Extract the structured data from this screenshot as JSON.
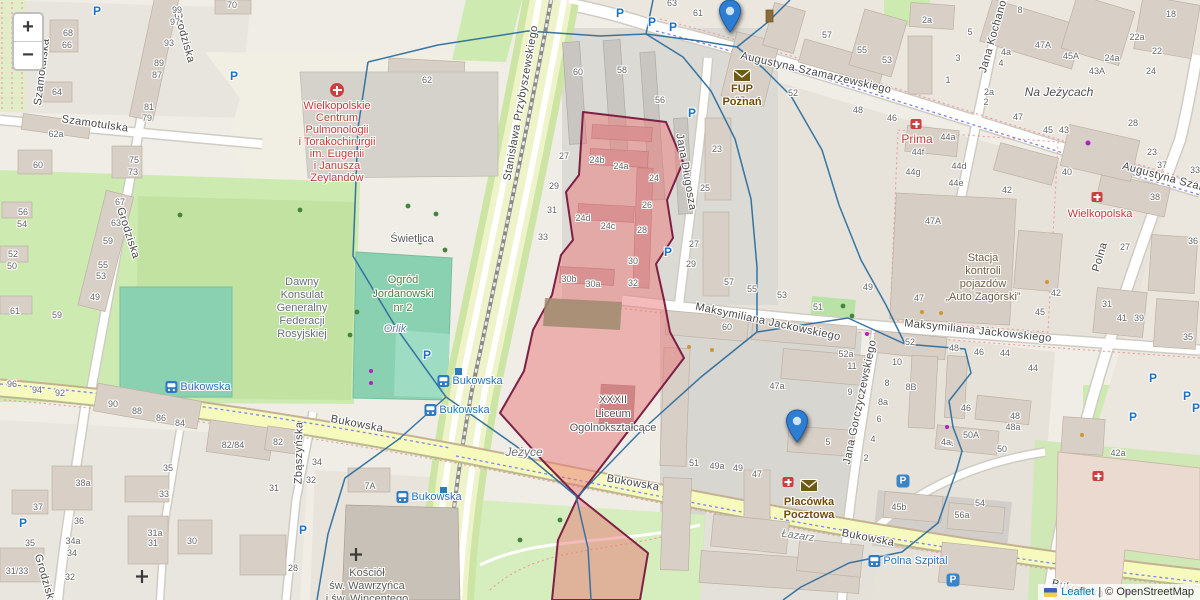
{
  "controls": {
    "zoom_in": "+",
    "zoom_out": "−"
  },
  "attribution": {
    "leaflet": "Leaflet",
    "separator": "|",
    "copyright": "© OpenStreetMap"
  },
  "colors": {
    "marker_blue": "#2d7ed3",
    "selection_fill": "#e87878",
    "selection_border": "#7d2046",
    "cell_line": "#2e6f9e",
    "transit_blue": "#2373bd",
    "poi_red": "#c33b36",
    "post_brown": "#734a08"
  },
  "markers": [
    {
      "id": "fup-poznan",
      "lines": [
        "FUP Poznań"
      ],
      "x": 742,
      "tip_y": 67,
      "label_dy": 16
    },
    {
      "id": "placowka-pocztowa",
      "lines": [
        "Placówka",
        "Pocztowa"
      ],
      "x": 809,
      "tip_y": 477,
      "label_dy": 19
    }
  ],
  "street_labels": [
    {
      "t": "Szamotulska",
      "x": 42,
      "y": 72,
      "r": -83
    },
    {
      "t": "Szamotulska",
      "x": 95,
      "y": 124,
      "r": 8
    },
    {
      "t": "Grodziska",
      "x": 184,
      "y": 37,
      "r": 74
    },
    {
      "t": "Grodziska",
      "x": 128,
      "y": 233,
      "r": 72
    },
    {
      "t": "Grodziska",
      "x": 45,
      "y": 580,
      "r": 74
    },
    {
      "t": "Stanisława Przybyszewskiego",
      "x": 521,
      "y": 103,
      "r": -80
    },
    {
      "t": "Augustyna Szamarzewskiego",
      "x": 816,
      "y": 73,
      "r": 13
    },
    {
      "t": "Augustyna Szamarzewskiego",
      "x": 1197,
      "y": 186,
      "r": 15
    },
    {
      "t": "Maksymiliana Jackowskiego",
      "x": 768,
      "y": 322,
      "r": 12
    },
    {
      "t": "Maksymiliana Jackowskiego",
      "x": 978,
      "y": 331,
      "r": 6
    },
    {
      "t": "Jana Długosza",
      "x": 686,
      "y": 172,
      "r": 80
    },
    {
      "t": "Jana Gorczyczewskiego",
      "x": 860,
      "y": 402,
      "r": -78
    },
    {
      "t": "Polna",
      "x": 1100,
      "y": 257,
      "r": -74
    },
    {
      "t": "Zbąszyńska",
      "x": 299,
      "y": 453,
      "r": -89
    },
    {
      "t": "Bukowska",
      "x": 357,
      "y": 424,
      "r": 11
    },
    {
      "t": "Bukowska",
      "x": 633,
      "y": 483,
      "r": 10
    },
    {
      "t": "Bukowska",
      "x": 868,
      "y": 538,
      "r": 11
    },
    {
      "t": "Bukowska",
      "x": 1078,
      "y": 589,
      "r": 12
    },
    {
      "t": "Jana Kochanowskiego",
      "x": 999,
      "y": 16,
      "r": -74
    }
  ],
  "place_labels": [
    {
      "lines": [
        "Wielkopolskie",
        "Centrum",
        "Pulmonologii",
        "i Torakochirurgii",
        "im. Eugenii",
        "i Janusza",
        "Zeylandów"
      ],
      "x": 337,
      "y": 100,
      "lh": 12,
      "color": "#c33b36"
    },
    {
      "lines": [
        "Prima"
      ],
      "x": 917,
      "y": 133,
      "lh": 12,
      "color": "#c33b36",
      "size": 12
    },
    {
      "lines": [
        "Wielkopolska"
      ],
      "x": 1100,
      "y": 208,
      "lh": 12,
      "color": "#c33b36"
    },
    {
      "lines": [
        "Stacja",
        "kontroli",
        "pojazdów",
        "„Auto Zagórski”"
      ],
      "x": 983,
      "y": 252,
      "lh": 13,
      "color": "#6f5b40"
    },
    {
      "lines": [
        "Dawny",
        "Konsulat",
        "Generalny",
        "Federacji",
        "Rosyjskiej"
      ],
      "x": 302,
      "y": 276,
      "lh": 13,
      "color": "#657075"
    },
    {
      "lines": [
        "Ogród",
        "Jordanowski",
        "nr 2"
      ],
      "x": 403,
      "y": 273,
      "lh": 14,
      "color": "#4c7e3c"
    },
    {
      "lines": [
        "Orlik"
      ],
      "x": 395,
      "y": 323,
      "lh": 12,
      "color": "#64869c",
      "italic": true
    },
    {
      "lines": [
        "Świetlica"
      ],
      "x": 412,
      "y": 233,
      "lh": 12,
      "color": "#5a5a5a"
    },
    {
      "lines": [
        "Jeżyce"
      ],
      "x": 524,
      "y": 446,
      "lh": 13,
      "color": "#707070",
      "italic": true,
      "size": 12
    },
    {
      "lines": [
        "Na Jeżycach"
      ],
      "x": 1059,
      "y": 86,
      "lh": 13,
      "color": "#4f4f4f",
      "italic": true,
      "size": 12
    },
    {
      "lines": [
        "Kościół",
        "św. Wawrzyńca",
        "i św. Wincentego"
      ],
      "x": 367,
      "y": 567,
      "lh": 13,
      "color": "#5c5c56"
    },
    {
      "lines": [
        "XXXII",
        "Liceum",
        "Ogólnokształcące"
      ],
      "x": 613,
      "y": 393,
      "lh": 14,
      "color": "#555555"
    },
    {
      "lines": [
        "Łazarz"
      ],
      "x": 798,
      "y": 530,
      "lh": 12,
      "color": "#777777",
      "italic": true,
      "rot": 8
    }
  ],
  "transit_labels": [
    {
      "t": "Bukowska",
      "x": 198,
      "y": 387
    },
    {
      "t": "Bukowska",
      "x": 470,
      "y": 381
    },
    {
      "t": "Bukowska",
      "x": 457,
      "y": 410
    },
    {
      "t": "Bukowska",
      "x": 429,
      "y": 497
    },
    {
      "t": "Polna Szpital",
      "x": 908,
      "y": 561
    }
  ],
  "parking_label": "P",
  "parking_icons": [
    {
      "x": 97,
      "y": 11
    },
    {
      "x": 234,
      "y": 76
    },
    {
      "x": 620,
      "y": 13
    },
    {
      "x": 652,
      "y": 22
    },
    {
      "x": 673,
      "y": 27
    },
    {
      "x": 692,
      "y": 113
    },
    {
      "x": 668,
      "y": 252
    },
    {
      "x": 427,
      "y": 355
    },
    {
      "x": 303,
      "y": 530
    },
    {
      "x": 23,
      "y": 523
    },
    {
      "x": 1153,
      "y": 378
    },
    {
      "x": 1187,
      "y": 396
    },
    {
      "x": 1196,
      "y": 408
    },
    {
      "x": 1133,
      "y": 417
    },
    {
      "x": 903,
      "y": 481,
      "boxed": true
    },
    {
      "x": 953,
      "y": 580,
      "boxed": true
    }
  ],
  "poi_icons": [
    {
      "type": "hospital",
      "x": 337,
      "y": 90
    },
    {
      "type": "aid",
      "x": 916,
      "y": 124
    },
    {
      "type": "aid",
      "x": 1097,
      "y": 197
    },
    {
      "type": "aid",
      "x": 788,
      "y": 482
    },
    {
      "type": "aid",
      "x": 1098,
      "y": 476
    }
  ],
  "building_numbers": [
    [
      "70",
      232,
      5
    ],
    [
      "99",
      177,
      10
    ],
    [
      "97",
      175,
      22
    ],
    [
      "93",
      169,
      43
    ],
    [
      "89",
      159,
      63
    ],
    [
      "87",
      157,
      75
    ],
    [
      "68",
      68,
      33
    ],
    [
      "66",
      67,
      45
    ],
    [
      "64",
      57,
      92
    ],
    [
      "81",
      149,
      107
    ],
    [
      "79",
      147,
      118
    ],
    [
      "62a",
      56,
      134
    ],
    [
      "60",
      38,
      165
    ],
    [
      "75",
      134,
      160
    ],
    [
      "73",
      133,
      172
    ],
    [
      "56",
      23,
      212
    ],
    [
      "54",
      22,
      224
    ],
    [
      "52",
      13,
      254
    ],
    [
      "50",
      12,
      266
    ],
    [
      "67",
      120,
      202
    ],
    [
      "63",
      116,
      223
    ],
    [
      "59",
      108,
      241
    ],
    [
      "55",
      103,
      265
    ],
    [
      "53",
      101,
      276
    ],
    [
      "49",
      95,
      297
    ],
    [
      "61",
      15,
      311
    ],
    [
      "59",
      57,
      315
    ],
    [
      "96",
      12,
      384
    ],
    [
      "94",
      37,
      390
    ],
    [
      "92",
      60,
      393
    ],
    [
      "62",
      427,
      80
    ],
    [
      "38a",
      83,
      483
    ],
    [
      "37",
      38,
      507
    ],
    [
      "36",
      79,
      521
    ],
    [
      "35",
      30,
      543
    ],
    [
      "34a",
      73,
      541
    ],
    [
      "34",
      72,
      553
    ],
    [
      "33",
      164,
      494
    ],
    [
      "31a",
      155,
      533
    ],
    [
      "31",
      153,
      543
    ],
    [
      "31/33",
      17,
      571
    ],
    [
      "32",
      70,
      577
    ],
    [
      "30",
      192,
      541
    ],
    [
      "90",
      113,
      404
    ],
    [
      "88",
      137,
      411
    ],
    [
      "86",
      161,
      418
    ],
    [
      "84",
      180,
      423
    ],
    [
      "82/84",
      233,
      445
    ],
    [
      "82",
      278,
      442
    ],
    [
      "35",
      168,
      468
    ],
    [
      "34",
      317,
      462
    ],
    [
      "32",
      311,
      480
    ],
    [
      "31",
      274,
      488
    ],
    [
      "28",
      293,
      568
    ],
    [
      "7A",
      370,
      486
    ],
    [
      "60",
      578,
      72
    ],
    [
      "58",
      622,
      70
    ],
    [
      "56",
      660,
      100
    ],
    [
      "63",
      672,
      3
    ],
    [
      "61",
      698,
      13
    ],
    [
      "22",
      727,
      15
    ],
    [
      "57",
      827,
      35
    ],
    [
      "55",
      862,
      50
    ],
    [
      "53",
      887,
      60
    ],
    [
      "52",
      793,
      93
    ],
    [
      "48",
      858,
      110
    ],
    [
      "46",
      892,
      118
    ],
    [
      "37",
      740,
      100
    ],
    [
      "24b",
      597,
      160
    ],
    [
      "24a",
      621,
      166
    ],
    [
      "24",
      654,
      178
    ],
    [
      "26",
      647,
      205
    ],
    [
      "24d",
      583,
      218
    ],
    [
      "24c",
      608,
      226
    ],
    [
      "28",
      642,
      230
    ],
    [
      "30",
      633,
      261
    ],
    [
      "30b",
      569,
      279
    ],
    [
      "30a",
      593,
      284
    ],
    [
      "32",
      633,
      283
    ],
    [
      "27",
      564,
      156
    ],
    [
      "29",
      554,
      186
    ],
    [
      "31",
      552,
      210
    ],
    [
      "33",
      543,
      237
    ],
    [
      "23",
      717,
      149
    ],
    [
      "25",
      705,
      188
    ],
    [
      "27",
      694,
      244
    ],
    [
      "29",
      691,
      264
    ],
    [
      "57",
      729,
      282
    ],
    [
      "55",
      752,
      289
    ],
    [
      "53",
      782,
      295
    ],
    [
      "51",
      818,
      307
    ],
    [
      "49",
      868,
      287
    ],
    [
      "47",
      919,
      298
    ],
    [
      "60",
      727,
      327
    ],
    [
      "52",
      910,
      342
    ],
    [
      "52a",
      846,
      354
    ],
    [
      "11",
      852,
      366
    ],
    [
      "10",
      897,
      362
    ],
    [
      "47a",
      777,
      386
    ],
    [
      "8",
      887,
      383
    ],
    [
      "8B",
      911,
      387
    ],
    [
      "9",
      850,
      392
    ],
    [
      "8a",
      883,
      402
    ],
    [
      "6",
      879,
      419
    ],
    [
      "4",
      873,
      439
    ],
    [
      "4a",
      948,
      443
    ],
    [
      "46",
      966,
      408
    ],
    [
      "48",
      1015,
      416
    ],
    [
      "48a",
      1013,
      427
    ],
    [
      "50A",
      971,
      435
    ],
    [
      "50",
      1002,
      449
    ],
    [
      "48",
      954,
      348
    ],
    [
      "46",
      979,
      352
    ],
    [
      "44",
      1005,
      353
    ],
    [
      "44",
      1033,
      368
    ],
    [
      "2a",
      927,
      20
    ],
    [
      "5",
      970,
      32
    ],
    [
      "3",
      958,
      58
    ],
    [
      "1",
      948,
      80
    ],
    [
      "4a",
      1006,
      52
    ],
    [
      "4",
      1001,
      63
    ],
    [
      "2a",
      989,
      92
    ],
    [
      "2",
      986,
      102
    ],
    [
      "8",
      1020,
      10
    ],
    [
      "47A",
      1043,
      45
    ],
    [
      "45A",
      1071,
      56
    ],
    [
      "43A",
      1097,
      71
    ],
    [
      "22a",
      1137,
      37
    ],
    [
      "24a",
      1112,
      58
    ],
    [
      "22",
      1157,
      51
    ],
    [
      "24",
      1151,
      71
    ],
    [
      "18",
      1171,
      14
    ],
    [
      "28",
      1133,
      123
    ],
    [
      "47",
      1018,
      117
    ],
    [
      "45",
      1048,
      130
    ],
    [
      "43",
      1064,
      130
    ],
    [
      "44a",
      948,
      137
    ],
    [
      "44f",
      918,
      152
    ],
    [
      "44d",
      959,
      166
    ],
    [
      "44g",
      913,
      172
    ],
    [
      "44e",
      956,
      183
    ],
    [
      "40",
      1067,
      172
    ],
    [
      "42",
      1007,
      190
    ],
    [
      "23",
      1152,
      152
    ],
    [
      "37",
      1162,
      165
    ],
    [
      "38",
      1155,
      197
    ],
    [
      "33",
      1195,
      170
    ],
    [
      "47A",
      933,
      221
    ],
    [
      "36",
      1193,
      241
    ],
    [
      "42",
      1056,
      293
    ],
    [
      "45",
      1040,
      312
    ],
    [
      "27",
      1125,
      247
    ],
    [
      "31",
      1107,
      304
    ],
    [
      "41",
      1122,
      318
    ],
    [
      "39",
      1139,
      318
    ],
    [
      "35",
      1188,
      337
    ],
    [
      "42a",
      1118,
      453
    ],
    [
      "47",
      757,
      474
    ],
    [
      "5",
      828,
      442
    ],
    [
      "2",
      866,
      458
    ],
    [
      "4a",
      946,
      442
    ],
    [
      "45b",
      899,
      507
    ],
    [
      "56a",
      962,
      515
    ],
    [
      "54",
      980,
      503
    ],
    [
      "51",
      694,
      463
    ],
    [
      "49a",
      717,
      466
    ],
    [
      "49",
      738,
      468
    ]
  ]
}
